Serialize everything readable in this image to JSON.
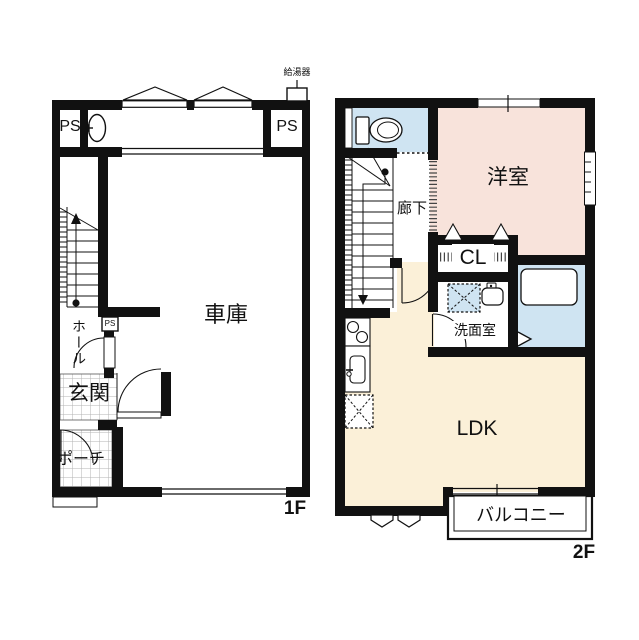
{
  "colors": {
    "wall": "#111111",
    "western_room": "#f8e3db",
    "ldk": "#fbf0d8",
    "wet": "#cfe4f2",
    "tile_line": "#b3b3b3"
  },
  "floor1": {
    "name": "1F",
    "garage": "車庫",
    "hall": "ホール",
    "entrance": "玄関",
    "porch": "ポーチ",
    "ps_left": "PS",
    "ps_right": "PS",
    "ps_small": "PS",
    "water_heater": "給湯器"
  },
  "floor2": {
    "name": "2F",
    "western_room": "洋室",
    "corridor": "廊下",
    "closet": "CL",
    "washroom": "洗面室",
    "ldk": "LDK",
    "balcony": "バルコニー"
  }
}
